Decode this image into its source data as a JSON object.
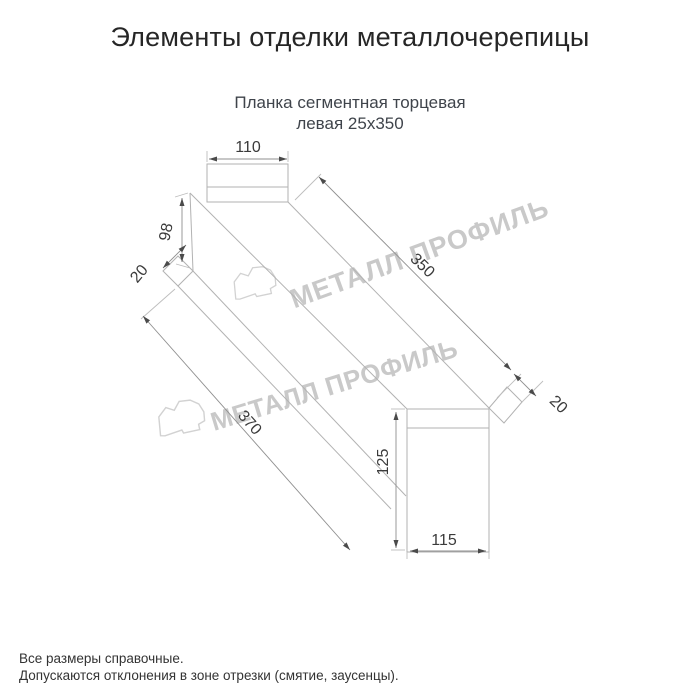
{
  "title": "Элементы отделки металлочерепицы",
  "subtitle": {
    "line1": "Планка сегментная торцевая",
    "line2": "левая 25х350"
  },
  "watermark": {
    "text": "МЕТАЛЛ ПРОФИЛЬ",
    "logo": "cloud-logo",
    "color": "#c9c9c9"
  },
  "drawing": {
    "type": "technical-dimension-drawing",
    "dims": {
      "top_width": "110",
      "side_height": "98",
      "left_fold": "20",
      "face_length": "350",
      "right_fold": "20",
      "overall_length": "370",
      "end_height": "125",
      "end_width": "115"
    }
  },
  "footer": {
    "line1": "Все размеры справочные.",
    "line2": "Допускаются отклонения в зоне отрезки (смятие, заусенцы)."
  },
  "colors": {
    "background": "#ffffff",
    "part_line": "#b2b2b2",
    "dim_line": "#8f8f8f",
    "dim_text": "#3b3b3b",
    "title_text": "#262626",
    "subtitle_text": "#3f444b",
    "footer_text": "#333333",
    "watermark": "#c9c9c9"
  }
}
